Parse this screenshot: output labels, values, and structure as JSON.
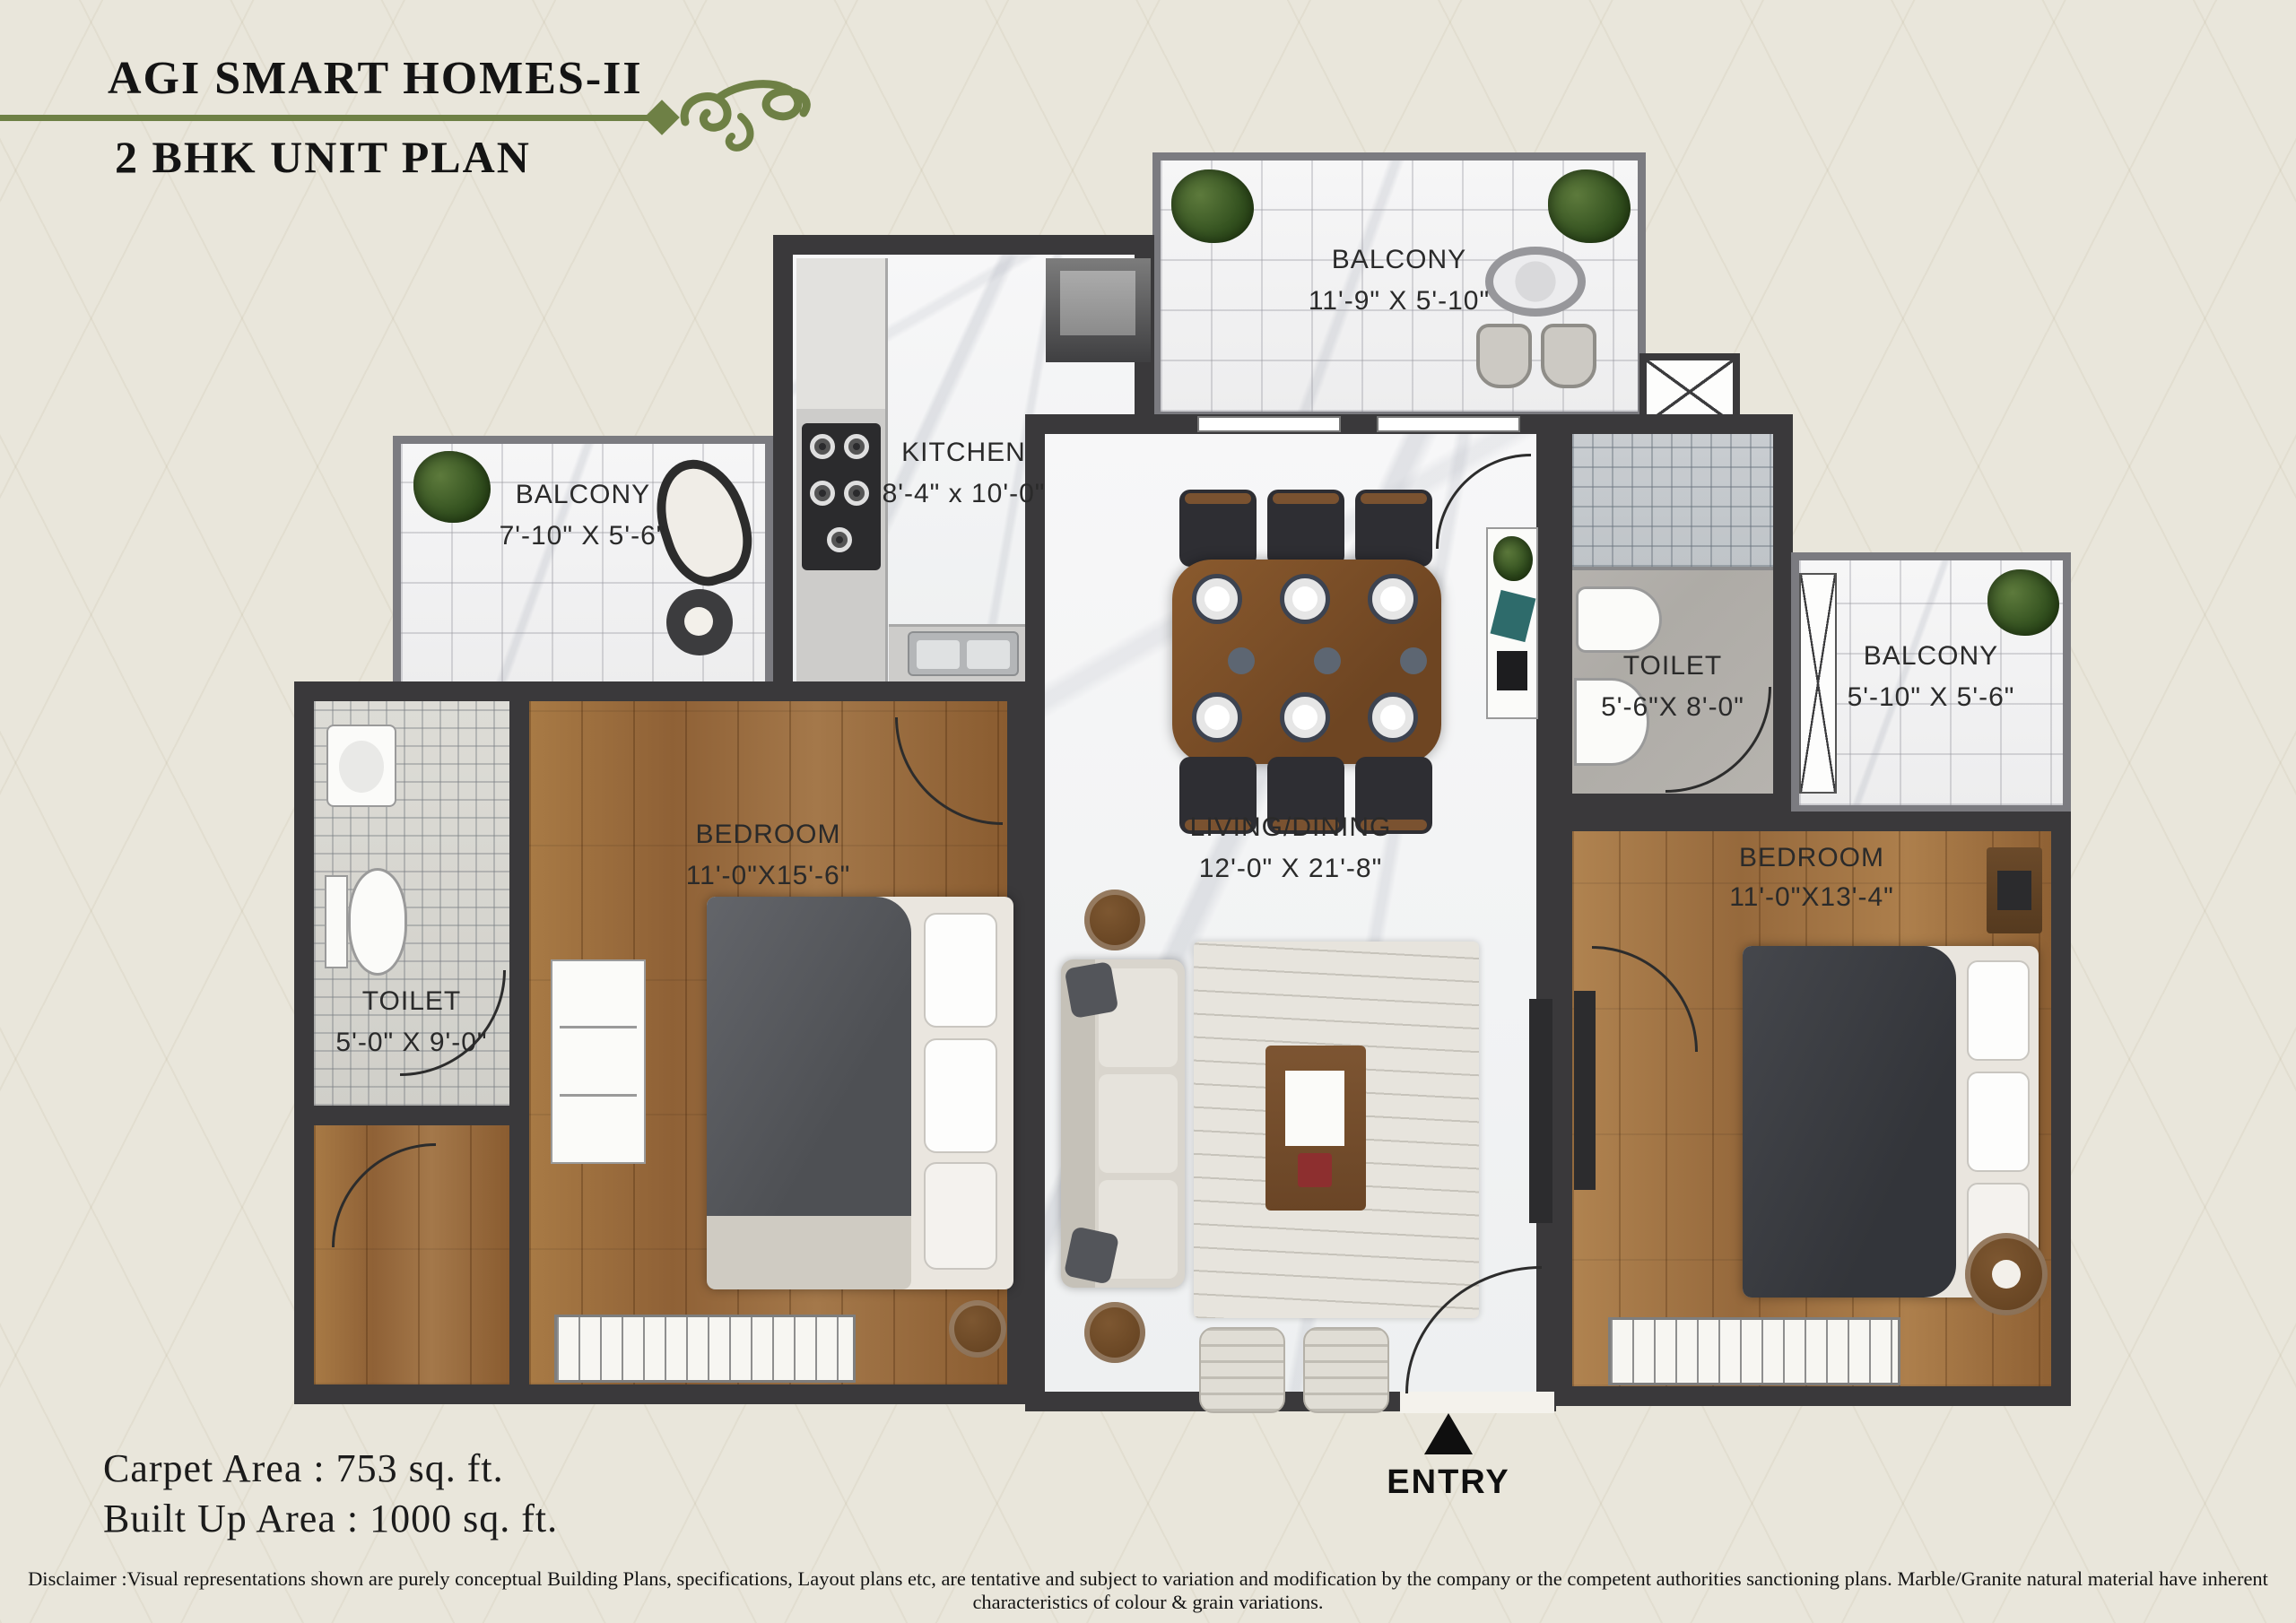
{
  "header": {
    "title": "AGI SMART HOMES-II",
    "subtitle": "2 BHK UNIT PLAN"
  },
  "rooms": {
    "balcony_top": {
      "name": "BALCONY",
      "size": "11'-9\" X 5'-10\""
    },
    "kitchen": {
      "name": "KITCHEN",
      "size": "8'-4\" x 10'-0\""
    },
    "balcony_left": {
      "name": "BALCONY",
      "size": "7'-10\" X 5'-6\""
    },
    "toilet_left": {
      "name": "TOILET",
      "size": "5'-0\" X 9'-0\""
    },
    "bedroom_left": {
      "name": "BEDROOM",
      "size": "11'-0\"X15'-6\""
    },
    "living_dining": {
      "name": "LIVING/DINING",
      "size": "12'-0\" X 21'-8\""
    },
    "toilet_right": {
      "name": "TOILET",
      "size": "5'-6\"X 8'-0\""
    },
    "balcony_right": {
      "name": "BALCONY",
      "size": "5'-10\" X 5'-6\""
    },
    "bedroom_right": {
      "name": "BEDROOM",
      "size": "11'-0\"X13'-4\""
    }
  },
  "entry": {
    "label": "ENTRY"
  },
  "areas": {
    "carpet": "Carpet Area : 753 sq. ft.",
    "built_up": "Built Up Area : 1000 sq. ft."
  },
  "disclaimer": "Disclaimer :Visual representations shown are purely conceptual Building Plans, specifications, Layout plans etc, are tentative and subject to variation and modification by the company or the competent authorities sanctioning plans. Marble/Granite natural material have inherent characteristics of colour & grain variations.",
  "colors": {
    "accent_green": "#6e8045",
    "wall": "#3a393b",
    "background": "#e9e6db",
    "wood": "#a0713c",
    "label_text": "#2a2a2a"
  }
}
